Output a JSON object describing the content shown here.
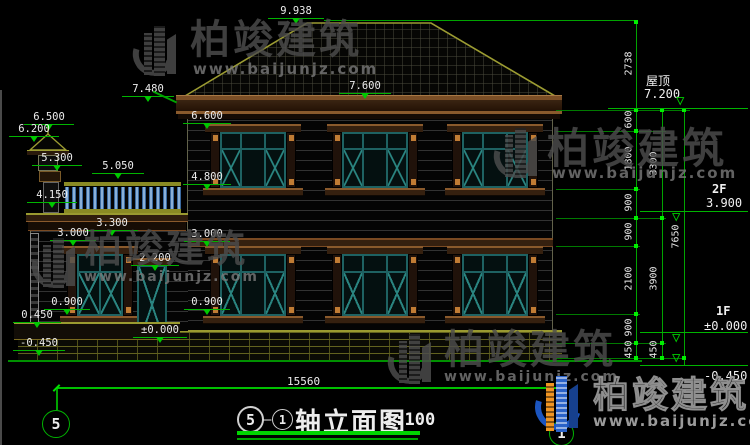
{
  "title": {
    "axis_start": "5",
    "axis_end": "1",
    "dash": "—",
    "name": "轴立面图",
    "scale": "1:100"
  },
  "bottom": {
    "overall_dim": "15560",
    "axis_left_bubble": "5",
    "axis_right_bubble": "1"
  },
  "levels_left": [
    "9.938",
    "7.480",
    "7.600",
    "6.600",
    "6.500",
    "6.200",
    "5.300",
    "5.050",
    "4.800",
    "4.150",
    "3.300",
    "3.000",
    "3.000",
    "2.200",
    "0.900",
    "0.900",
    "0.450",
    "±0.000",
    "-0.450"
  ],
  "levels_right": {
    "roof_name": "屋顶",
    "roof_value": "7.200",
    "f2_name": "2F",
    "f2_value": "3.900",
    "f1_name": "1F",
    "f1_value": "±0.000",
    "ground_value": "-0.450"
  },
  "dims": {
    "chain_a": [
      "2738",
      "600",
      "1800",
      "900",
      "900",
      "2100",
      "900",
      "450"
    ],
    "chain_b": [
      "3300",
      "3900",
      "450"
    ],
    "chain_c": [
      "7650"
    ]
  },
  "watermark": {
    "brand": "柏竣建筑",
    "url": "www.baijunjz.com"
  },
  "colors": {
    "dimension_green": "#00b400",
    "cad_text_white": "#ececec",
    "roof_outline_olive": "#9c9c32",
    "window_frame_teal": "#1e6262",
    "trim_brown": "#35200f",
    "accent_orange_block": "#c07c34",
    "baluster_blue": "#3a6aa0",
    "logo_blue": "#1b55c0",
    "logo_orange": "#f09522"
  }
}
